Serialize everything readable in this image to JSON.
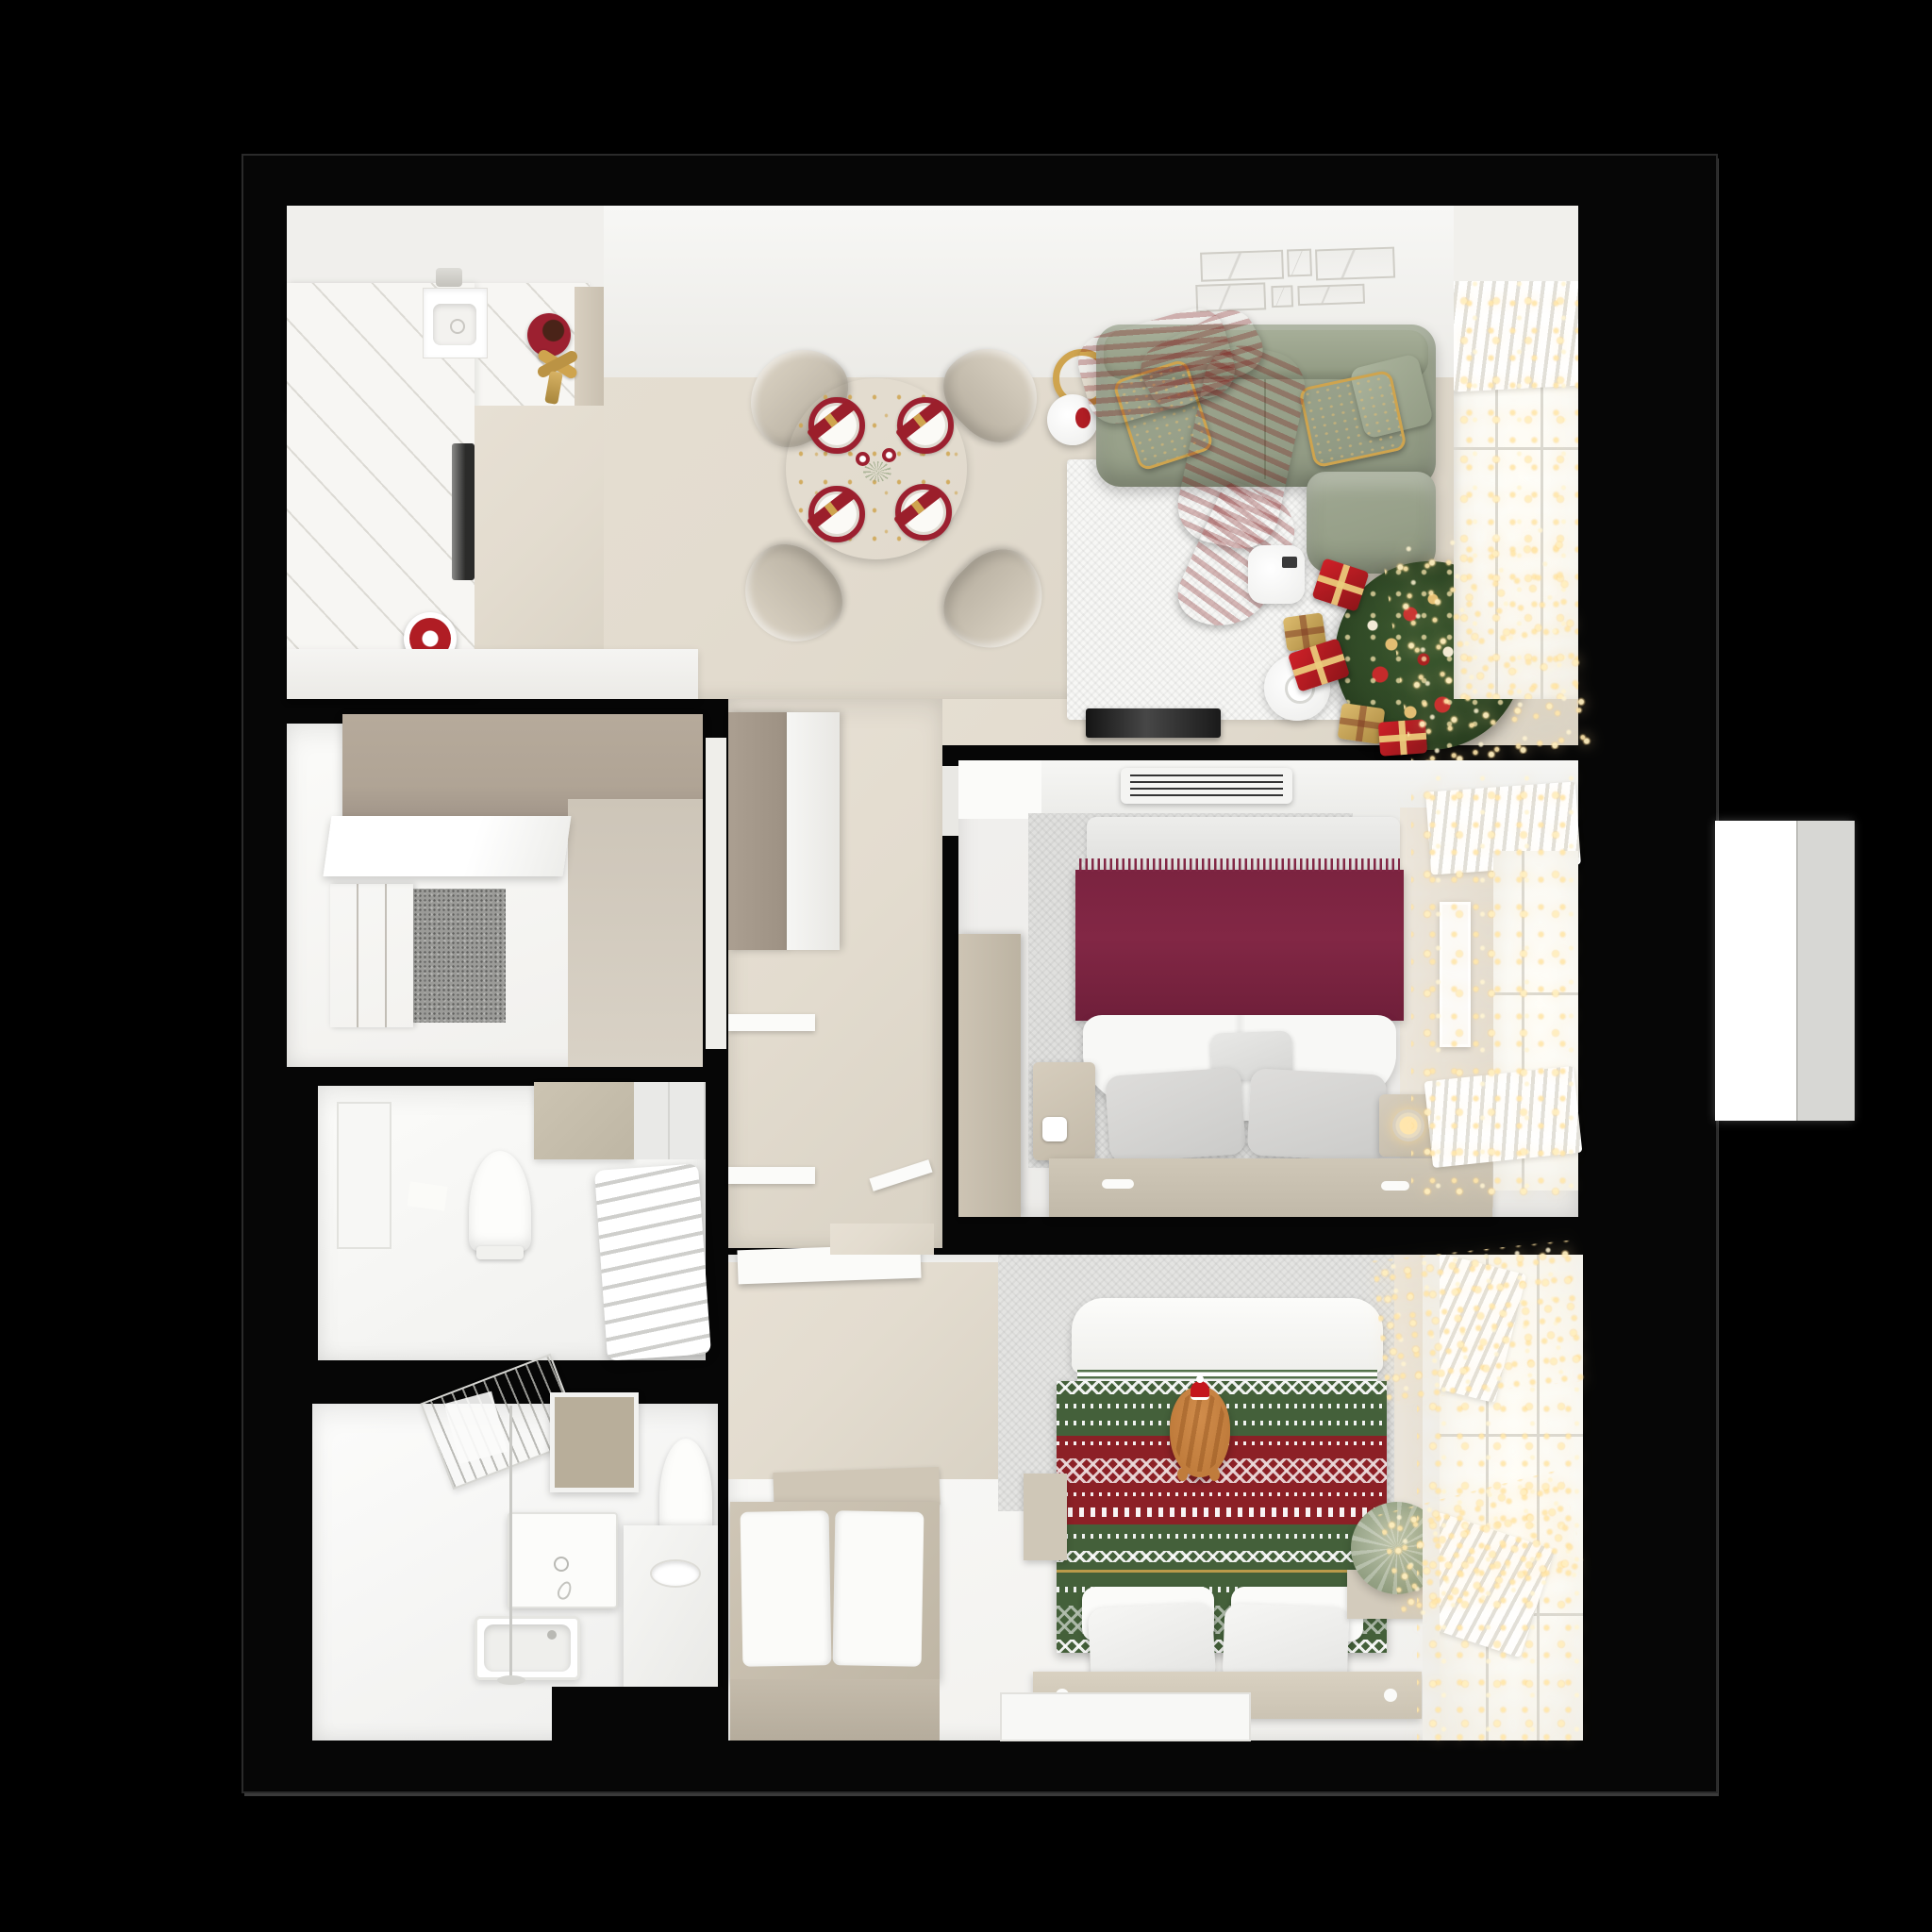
{
  "scene": {
    "description": "Top-down 3D render of a two-bedroom apartment decorated for Christmas, isolated on a black background",
    "background": "#000000",
    "style": "photoreal floorplan cutaway"
  },
  "palette": {
    "wall-black": "#060606",
    "floor-beige": "#e3dccf",
    "floor-white": "#f5f4f1",
    "counter-white": "#f7f6f3",
    "taupe-wall": "#b0a495",
    "beige-wall": "#cdc5b8",
    "wardrobe-beige": "#d5ccbe",
    "sofa-green": "#97a089",
    "pillow-red": "#9b1f2b",
    "throw-red": "#b01d24",
    "plate-red": "#9c2030",
    "burgundy": "#822745",
    "knit-green": "#44603a",
    "knit-red": "#8c2026",
    "gold": "#cfa44e",
    "tree-green": "#2c4423",
    "ornament-red": "#c62b2b",
    "ornament-gold": "#e2bd72",
    "cat-orange": "#c07c3c",
    "platform-beige": "#cfc7b7",
    "window-white": "#fbfaf5",
    "light-warm": "#ffe6ae"
  },
  "rooms": [
    {
      "id": "kitchen",
      "label": "Kitchen",
      "items": [
        "l-shaped-white-counter",
        "sink",
        "oven",
        "red-pot",
        "red-gift-plate",
        "gold-bow"
      ]
    },
    {
      "id": "dining-area",
      "label": "Dining area",
      "items": [
        "round-festive-table",
        "four-chairs",
        "red-plates-with-napkins",
        "centerpiece"
      ]
    },
    {
      "id": "living-room",
      "label": "Living room",
      "items": [
        "green-corner-sofa",
        "red-throw-blanket",
        "red-gold-pillows",
        "gold-ring-lamp",
        "white-rug",
        "humidifier",
        "coffee-table",
        "tv-console",
        "christmas-tree",
        "gift-boxes",
        "wall-art",
        "window-with-fairy-lights"
      ]
    },
    {
      "id": "entry-hall",
      "label": "Entry hall",
      "items": [
        "wardrobe",
        "console-shelf",
        "doormat"
      ]
    },
    {
      "id": "wc",
      "label": "WC",
      "items": [
        "toilet",
        "towel-radiator",
        "beige-tile-panel"
      ]
    },
    {
      "id": "bathroom",
      "label": "Bathroom",
      "items": [
        "drying-rack",
        "mirror",
        "washing-machine",
        "bathtub",
        "toilet",
        "vanity-with-sink",
        "floor-lamp"
      ]
    },
    {
      "id": "corridor",
      "label": "Corridor",
      "items": [
        "built-in-closet",
        "door-leaves"
      ]
    },
    {
      "id": "bedroom-master",
      "label": "Master bedroom",
      "items": [
        "double-bed",
        "burgundy-fringed-throw",
        "gray-pillows",
        "nightstands",
        "wardrobe-column",
        "ac-vent",
        "window-fairy-lights",
        "wall-light-frame"
      ]
    },
    {
      "id": "bedroom-second",
      "label": "Second bedroom",
      "items": [
        "bed-with-christmas-knit-blanket",
        "ginger-cat-with-santa-hat",
        "white-pillows",
        "bench-with-cushions",
        "spruce-plant",
        "window-fairy-lights"
      ]
    }
  ]
}
